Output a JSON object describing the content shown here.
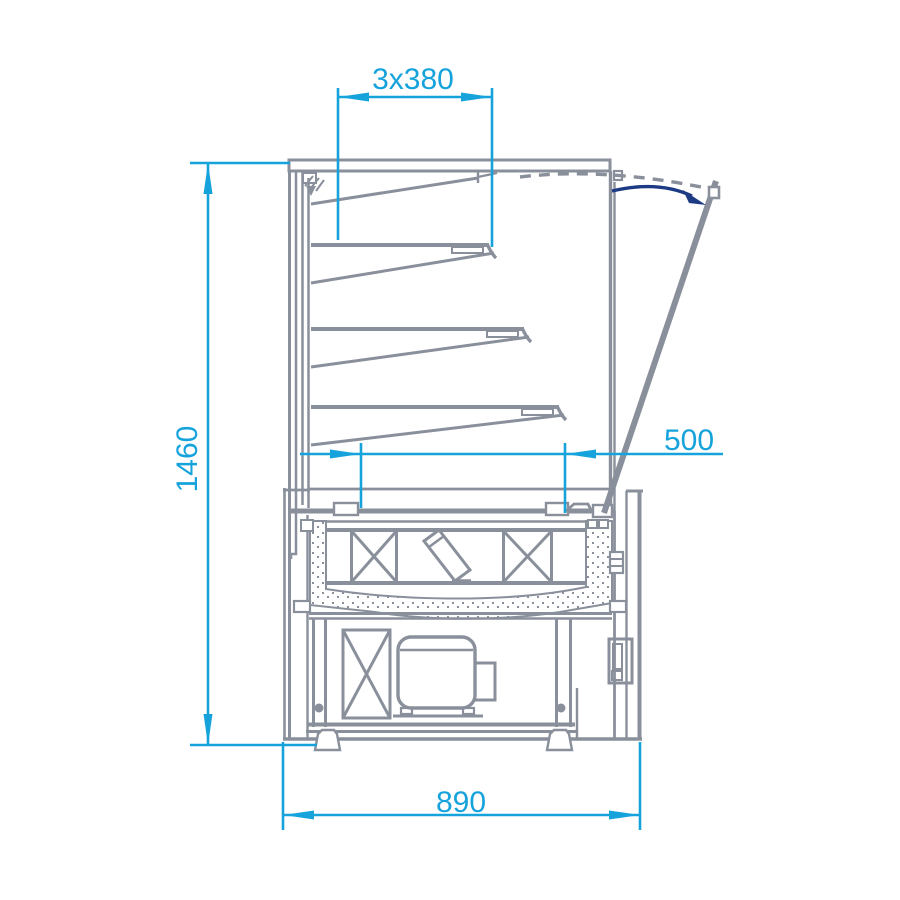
{
  "drawing": {
    "view": "refrigerated-display-cabinet-side-section",
    "dimensions": {
      "shelf_depth": "3x380",
      "overall_height": "1460",
      "inner_depth": "500",
      "overall_depth": "890"
    },
    "colors": {
      "dimension_lines": "#16A3DC",
      "structure_lines": "#8A909B",
      "swing_arrow": "#1D3B85",
      "background": "#FFFFFF"
    }
  }
}
